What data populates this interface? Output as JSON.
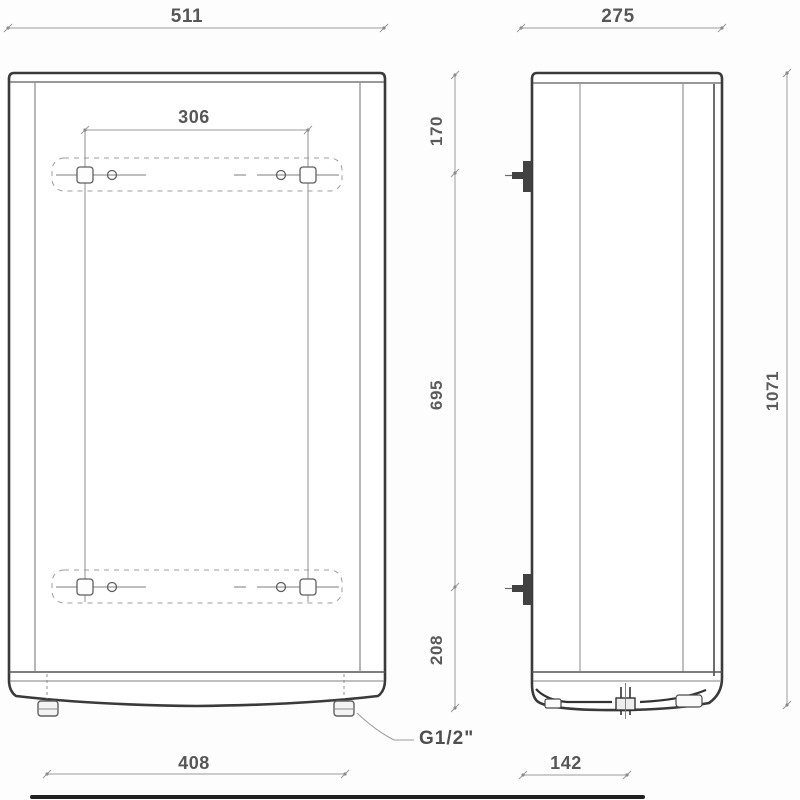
{
  "drawing_title": "water-heater-dimension-drawing",
  "labels": {
    "front_width": "511",
    "hole_spacing_horizontal": "306",
    "top_to_upper_hole": "170",
    "upper_to_lower_hole": "695",
    "lower_hole_to_bottom": "208",
    "total_height": "1071",
    "side_depth": "275",
    "feet_spacing": "408",
    "pipe_offset": "142",
    "connection_thread": "G1/2\""
  }
}
